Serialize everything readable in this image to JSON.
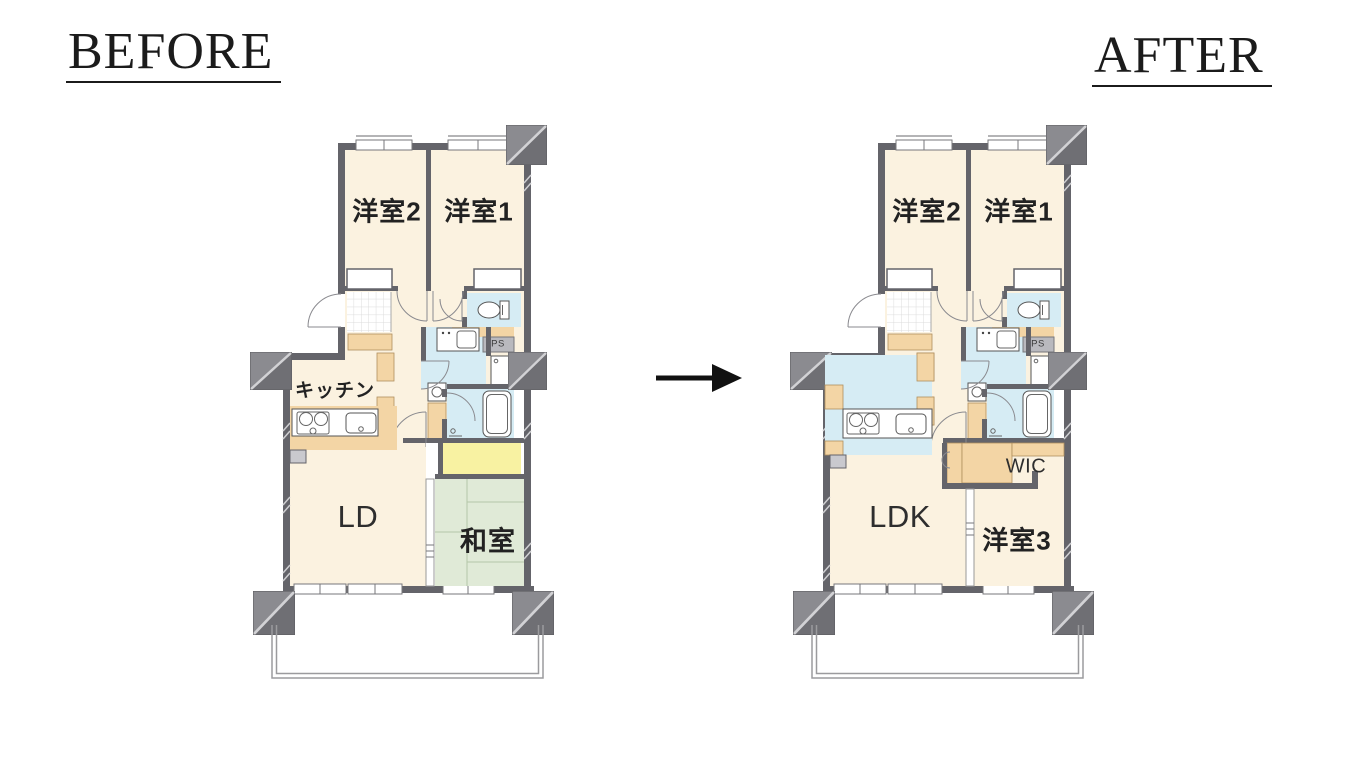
{
  "page": {
    "background_color": "#ffffff"
  },
  "comparison": {
    "arrow_icon": "right-arrow",
    "before": {
      "title": "BEFORE",
      "rooms": {
        "bedroom2": "洋室2",
        "bedroom1": "洋室1",
        "kitchen": "キッチン",
        "living_dining": "LD",
        "japanese_room": "和室",
        "pipe_space": "PS"
      }
    },
    "after": {
      "title": "AFTER",
      "rooms": {
        "bedroom2": "洋室2",
        "bedroom1": "洋室1",
        "living_dining_kitchen": "LDK",
        "walk_in_closet": "WIC",
        "bedroom3": "洋室3",
        "pipe_space": "PS"
      }
    },
    "colors": {
      "page_bg": "#ffffff",
      "title_text": "#1B1B1B",
      "room_floor": "#FBF2E0",
      "tatami_green": "#E0EAD7",
      "water_blue": "#D6ECF4",
      "closet_yellow": "#F8F2A2",
      "wood_tan": "#F3D5A5",
      "wall_gray": "#64646A",
      "pillar_gray": "#8B8B90"
    }
  }
}
